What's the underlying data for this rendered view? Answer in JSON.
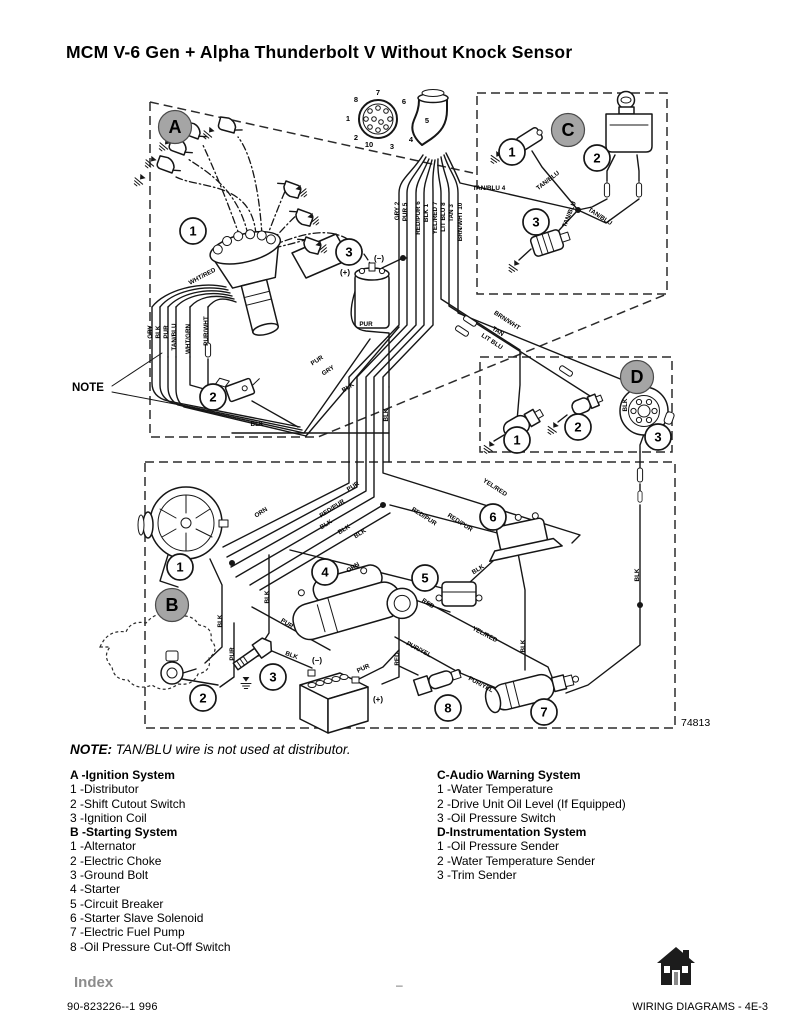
{
  "page": {
    "title": "MCM V-6 Gen + Alpha Thunderbolt V Without Knock Sensor",
    "note_label": "NOTE:",
    "note_text": " TAN/BLU wire is not used at distributor."
  },
  "colors": {
    "section_circle_fill": "#a5a5a5",
    "index_gray": "#8c8c8c"
  },
  "diagram": {
    "number": "74813",
    "note_pointer": "NOTE",
    "section_circles": [
      {
        "l": "A",
        "x": 175,
        "y": 42
      },
      {
        "l": "C",
        "x": 568,
        "y": 45
      },
      {
        "l": "D",
        "x": 637,
        "y": 292
      },
      {
        "l": "B",
        "x": 172,
        "y": 520
      }
    ],
    "callouts": [
      {
        "s": "a",
        "n": "1",
        "x": 193,
        "y": 146
      },
      {
        "s": "a",
        "n": "2",
        "x": 213,
        "y": 312
      },
      {
        "s": "a",
        "n": "3",
        "x": 349,
        "y": 167
      },
      {
        "s": "c",
        "n": "1",
        "x": 512,
        "y": 67
      },
      {
        "s": "c",
        "n": "2",
        "x": 597,
        "y": 73
      },
      {
        "s": "c",
        "n": "3",
        "x": 536,
        "y": 137
      },
      {
        "s": "d",
        "n": "1",
        "x": 517,
        "y": 355
      },
      {
        "s": "d",
        "n": "2",
        "x": 578,
        "y": 342
      },
      {
        "s": "d",
        "n": "3",
        "x": 658,
        "y": 352
      },
      {
        "s": "b",
        "n": "1",
        "x": 180,
        "y": 482
      },
      {
        "s": "b",
        "n": "2",
        "x": 203,
        "y": 613
      },
      {
        "s": "b",
        "n": "3",
        "x": 273,
        "y": 592
      },
      {
        "s": "b",
        "n": "4",
        "x": 325,
        "y": 487
      },
      {
        "s": "b",
        "n": "5",
        "x": 425,
        "y": 493
      },
      {
        "s": "b",
        "n": "6",
        "x": 493,
        "y": 432
      },
      {
        "s": "b",
        "n": "7",
        "x": 544,
        "y": 627
      },
      {
        "s": "b",
        "n": "8",
        "x": 448,
        "y": 623
      }
    ],
    "connector_pins": [
      {
        "n": "7",
        "x": 378,
        "y": 10
      },
      {
        "n": "6",
        "x": 404,
        "y": 19
      },
      {
        "n": "5",
        "x": 427,
        "y": 38
      },
      {
        "n": "4",
        "x": 411,
        "y": 57
      },
      {
        "n": "3",
        "x": 392,
        "y": 64
      },
      {
        "n": "10",
        "x": 369,
        "y": 62
      },
      {
        "n": "2",
        "x": 356,
        "y": 55
      },
      {
        "n": "1",
        "x": 348,
        "y": 36
      },
      {
        "n": "8",
        "x": 356,
        "y": 17
      }
    ],
    "wire_labels": [
      {
        "t": "GRY 2",
        "x": 399,
        "y": 126,
        "r": -90
      },
      {
        "t": "PUR 5",
        "x": 407,
        "y": 127,
        "r": -90
      },
      {
        "t": "RED/PUR 6",
        "x": 420,
        "y": 133,
        "r": -90
      },
      {
        "t": "BLK 1",
        "x": 428,
        "y": 128,
        "r": -90
      },
      {
        "t": "YEL/RED 7",
        "x": 437,
        "y": 133,
        "r": -90
      },
      {
        "t": "LIT BLU 8",
        "x": 445,
        "y": 132,
        "r": -90
      },
      {
        "t": "TAN 3",
        "x": 453,
        "y": 128,
        "r": -90
      },
      {
        "t": "BRN/WHT 10",
        "x": 462,
        "y": 137,
        "r": -90
      },
      {
        "t": "TAN/BLU 4",
        "x": 489,
        "y": 105,
        "r": 0
      },
      {
        "t": "TAN/BLU",
        "x": 549,
        "y": 97,
        "r": -38
      },
      {
        "t": "TAN/BLU",
        "x": 571,
        "y": 130,
        "r": -68
      },
      {
        "t": "TAN/BLU",
        "x": 599,
        "y": 133,
        "r": 33
      },
      {
        "t": "GRY",
        "x": 152,
        "y": 247,
        "r": -90
      },
      {
        "t": "BLK",
        "x": 160,
        "y": 247,
        "r": -90
      },
      {
        "t": "PUR",
        "x": 168,
        "y": 247,
        "r": -90
      },
      {
        "t": "TAN/BLU",
        "x": 176,
        "y": 252,
        "r": -90
      },
      {
        "t": "WHT/GRN",
        "x": 190,
        "y": 254,
        "r": -90
      },
      {
        "t": "PUR/WHT",
        "x": 208,
        "y": 246,
        "r": -90
      },
      {
        "t": "WHT/RED",
        "x": 203,
        "y": 193,
        "r": -28
      },
      {
        "t": "PUR",
        "x": 366,
        "y": 241,
        "r": 0
      },
      {
        "t": "PUR",
        "x": 318,
        "y": 277,
        "r": -33
      },
      {
        "t": "GRY",
        "x": 329,
        "y": 287,
        "r": -33
      },
      {
        "t": "BLK",
        "x": 349,
        "y": 304,
        "r": -33
      },
      {
        "t": "BLK",
        "x": 257,
        "y": 341,
        "r": 0
      },
      {
        "t": "BLK",
        "x": 388,
        "y": 330,
        "r": -90
      },
      {
        "t": "(+)",
        "x": 345,
        "y": 190,
        "r": 0,
        "b": 1
      },
      {
        "t": "(−)",
        "x": 379,
        "y": 176,
        "r": 0,
        "b": 1
      },
      {
        "t": "BRN/WHT",
        "x": 506,
        "y": 237,
        "r": 33
      },
      {
        "t": "TAN",
        "x": 497,
        "y": 248,
        "r": 33
      },
      {
        "t": "LIT BLU",
        "x": 491,
        "y": 258,
        "r": 33
      },
      {
        "t": "BLK",
        "x": 627,
        "y": 320,
        "r": -90
      },
      {
        "t": "BLK",
        "x": 639,
        "y": 490,
        "r": -90
      },
      {
        "t": "PUR",
        "x": 354,
        "y": 403,
        "r": -33
      },
      {
        "t": "RED/PUR",
        "x": 333,
        "y": 425,
        "r": -33
      },
      {
        "t": "ORN",
        "x": 262,
        "y": 429,
        "r": -33
      },
      {
        "t": "BLK",
        "x": 327,
        "y": 441,
        "r": -33
      },
      {
        "t": "BLK",
        "x": 345,
        "y": 446,
        "r": -33
      },
      {
        "t": "BLK",
        "x": 361,
        "y": 450,
        "r": -33
      },
      {
        "t": "ORN",
        "x": 354,
        "y": 484,
        "r": -33
      },
      {
        "t": "RED/PUR",
        "x": 423,
        "y": 433,
        "r": 33
      },
      {
        "t": "RED/PUR",
        "x": 459,
        "y": 439,
        "r": 33
      },
      {
        "t": "YEL/RED",
        "x": 494,
        "y": 404,
        "r": 33
      },
      {
        "t": "BLK",
        "x": 479,
        "y": 486,
        "r": -33
      },
      {
        "t": "RED",
        "x": 427,
        "y": 520,
        "r": 33
      },
      {
        "t": "BLK",
        "x": 222,
        "y": 536,
        "r": -90
      },
      {
        "t": "BLK",
        "x": 269,
        "y": 512,
        "r": -90
      },
      {
        "t": "PUR",
        "x": 234,
        "y": 569,
        "r": -90
      },
      {
        "t": "PUR",
        "x": 286,
        "y": 540,
        "r": 33
      },
      {
        "t": "BLK",
        "x": 291,
        "y": 572,
        "r": 20
      },
      {
        "t": "PUR",
        "x": 364,
        "y": 585,
        "r": -25
      },
      {
        "t": "RED",
        "x": 399,
        "y": 574,
        "r": -90
      },
      {
        "t": "PUR/YEL",
        "x": 418,
        "y": 566,
        "r": 28
      },
      {
        "t": "PUR/YEL",
        "x": 480,
        "y": 601,
        "r": 28
      },
      {
        "t": "YEL/RED",
        "x": 484,
        "y": 551,
        "r": 28
      },
      {
        "t": "BLK",
        "x": 525,
        "y": 561,
        "r": -90
      },
      {
        "t": "(−)",
        "x": 317,
        "y": 578,
        "r": 0,
        "b": 1
      },
      {
        "t": "(+)",
        "x": 378,
        "y": 617,
        "r": 0,
        "b": 1
      }
    ]
  },
  "legend": {
    "a": {
      "heading": "A -Ignition System",
      "items": [
        "1 -Distributor",
        "2 -Shift Cutout Switch",
        "3 -Ignition Coil"
      ]
    },
    "b": {
      "heading": "B -Starting System",
      "items": [
        "1 -Alternator",
        "2 -Electric Choke",
        "3 -Ground Bolt",
        "4 -Starter",
        "5 -Circuit Breaker",
        "6 -Starter Slave Solenoid",
        "7 -Electric Fuel Pump",
        "8 -Oil Pressure Cut-Off Switch"
      ]
    },
    "c": {
      "heading": "C-Audio Warning System",
      "items": [
        "1 -Water Temperature",
        "2 -Drive Unit Oil Level (If Equipped)",
        "3 -Oil Pressure Switch"
      ]
    },
    "d": {
      "heading": "D-Instrumentation System",
      "items": [
        "1 -Oil Pressure Sender",
        "2 -Water Temperature Sender",
        "3 -Trim Sender"
      ]
    }
  },
  "footer": {
    "index_label": "Index",
    "doc_number": "90-823226--1  996",
    "center_mark": "–",
    "page_ref": "WIRING DIAGRAMS - 4E-3"
  }
}
